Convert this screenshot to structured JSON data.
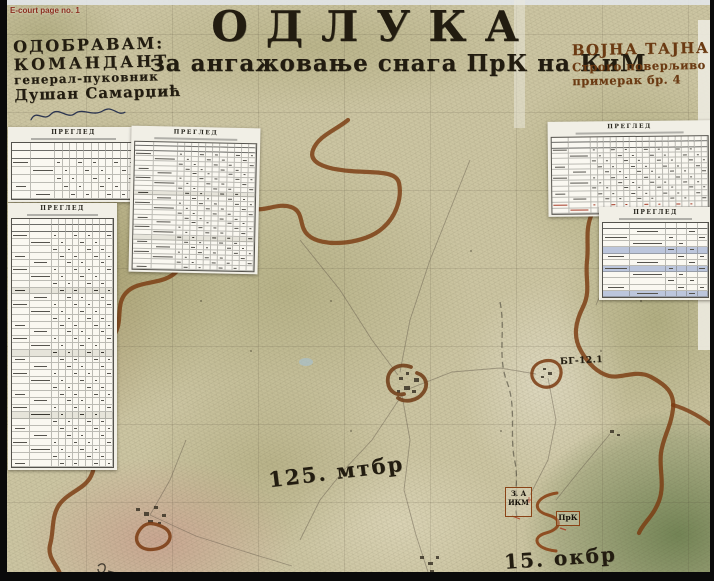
{
  "page": {
    "source_label": "E-court page no. 1"
  },
  "approval": {
    "lines": [
      "ОДОБРАВАМ:",
      "КОМАНДАНТ",
      "генерал-пуковник",
      "Душан Самарџић"
    ]
  },
  "title": {
    "main": "ОДЛУКА",
    "subtitle": "за ангажовање снага ПрК на КиМ"
  },
  "classification": {
    "lines": [
      "ВОЈНА ТАЈНА",
      "Строго поверљиво",
      "примерак бр. 4"
    ]
  },
  "tables": [
    {
      "name": "pregled-upper-left",
      "title": "ПРЕГЛЕД",
      "rows": 7,
      "cols": 13,
      "header_rows": 2
    },
    {
      "name": "pregled-left-tall",
      "title": "ПРЕГЛЕД",
      "rows": 36,
      "cols": 11,
      "header_rows": 2,
      "group_every": 9
    },
    {
      "name": "pregled-center",
      "title": "ПРЕГЛЕД",
      "rows": 26,
      "cols": 13,
      "header_rows": 2,
      "group_every": 9
    },
    {
      "name": "pregled-upper-right",
      "title": "ПРЕГЛЕД",
      "rows": 14,
      "cols": 20,
      "header_rows": 2,
      "red_last_rows": 2
    },
    {
      "name": "pregled-right",
      "title": "ПРЕГЛЕД",
      "rows": 12,
      "cols": 6,
      "header_rows": 1,
      "highlight_rows": [
        4,
        7,
        11
      ]
    }
  ],
  "map_labels": {
    "brigade_125": "125. мтбр",
    "brigade_15": "15. окбр",
    "bg_12_1": "БГ-12.1"
  },
  "unit_boxes": {
    "ikm": {
      "line1": "З. А",
      "line2": "ИКМ"
    },
    "prk": {
      "line1": "ПрК"
    }
  },
  "colors": {
    "boundary_brown": "#7a3a10",
    "ink_black": "#221c10",
    "ink_brown": "#6b3a12",
    "ecourt_red": "#8c2f20",
    "highlight_blue": "#bcc6dc",
    "paper": "#f1efe6",
    "map_base": "#ccc5a2"
  }
}
